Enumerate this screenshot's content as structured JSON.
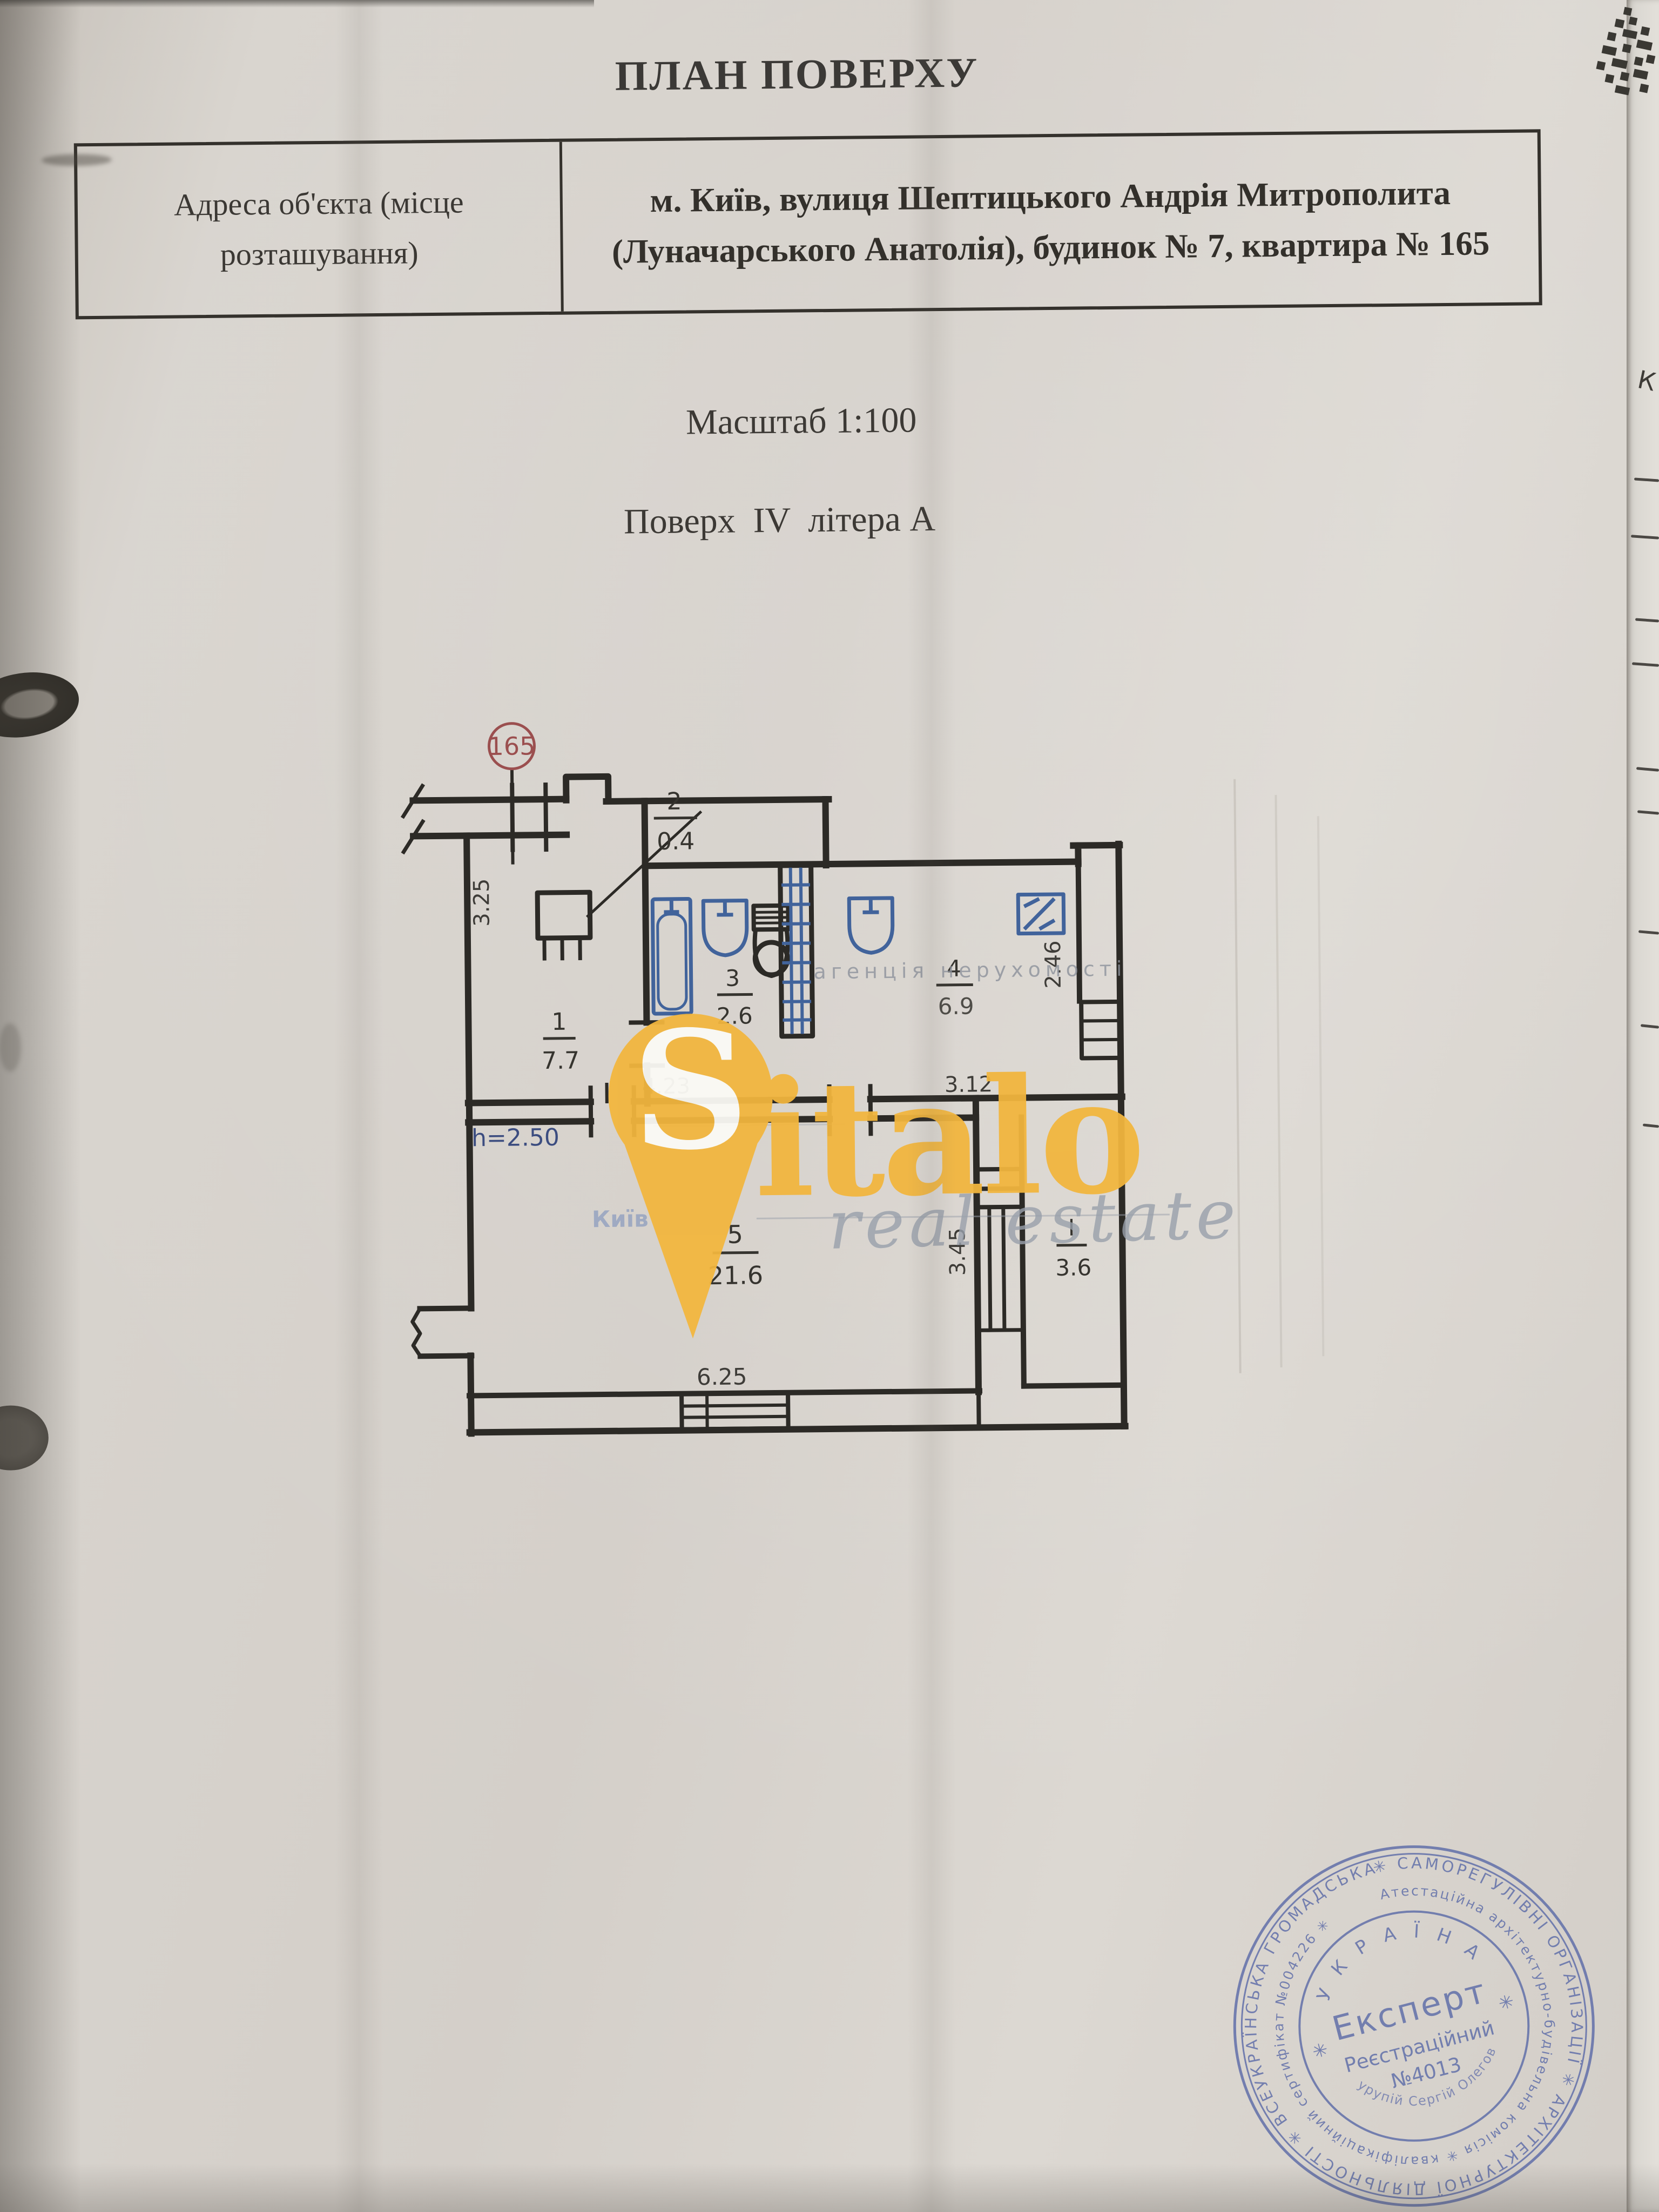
{
  "document": {
    "title": "ПЛАН ПОВЕРХУ",
    "address_table": {
      "label_line1": "Адреса об'єкта (місце",
      "label_line2": "розташування)",
      "value_line1": "м. Київ, вулиця Шептицького Андрія Митрополита",
      "value_line2": "(Луначарського Анатолія), будинок № 7, квартира № 165"
    },
    "scale": "Масштаб 1:100",
    "floor": "Поверх  IV  літера А"
  },
  "plan": {
    "apartment_number": "165",
    "rooms": [
      {
        "num": "1",
        "area": "7.7"
      },
      {
        "num": "2",
        "area": "0.4"
      },
      {
        "num": "3",
        "area": "2.6"
      },
      {
        "num": "4",
        "area": "6.9"
      },
      {
        "num": "5",
        "area": "21.6"
      },
      {
        "num": "I",
        "area": "3.6"
      }
    ],
    "dims": {
      "left_wall": "3.25",
      "mid_left": "4.23",
      "mid_right": "3.12",
      "right_wall": "2.46",
      "balcony": "3.45",
      "bottom": "6.25",
      "ceiling_height": "h=2.50"
    },
    "ink_color": "#2c2a26",
    "fixture_color": "#41639b",
    "apartment_circle_color": "#9b4f4f"
  },
  "watermark": {
    "brand_initial": "S",
    "brand_rest": "italo",
    "tagline": "real estate",
    "agency_line": "агенція нерухомості",
    "city": "Київ",
    "accent_color": "#f2b63e"
  },
  "stamp": {
    "center_line1": "Експерт",
    "center_line2": "Реєстраційний",
    "center_line3": "№4013",
    "country": "У К Р А Ї Н А",
    "outer_ring": "✳ САМОРЕГУЛІВНІ ОРГАНІЗАЦІЇ ✳ АРХІТЕКТУРНОЇ ДІЯЛЬНОСТІ ✳ ВСЕУКРАЇНСЬКА ГРОМАДСЬКА ОРГАНІЗАЦІЯ",
    "mid_ring": "Атестаційна архітектурно-будівельна комісія ✳ кваліфікаційний сертифікат №004226 ✳",
    "expert_name": "Шкурупій Сергій Олегович",
    "ink_color": "#5d6ca8",
    "star_left": "✳",
    "star_right": "✳"
  },
  "under_page": {
    "letter": "К"
  }
}
